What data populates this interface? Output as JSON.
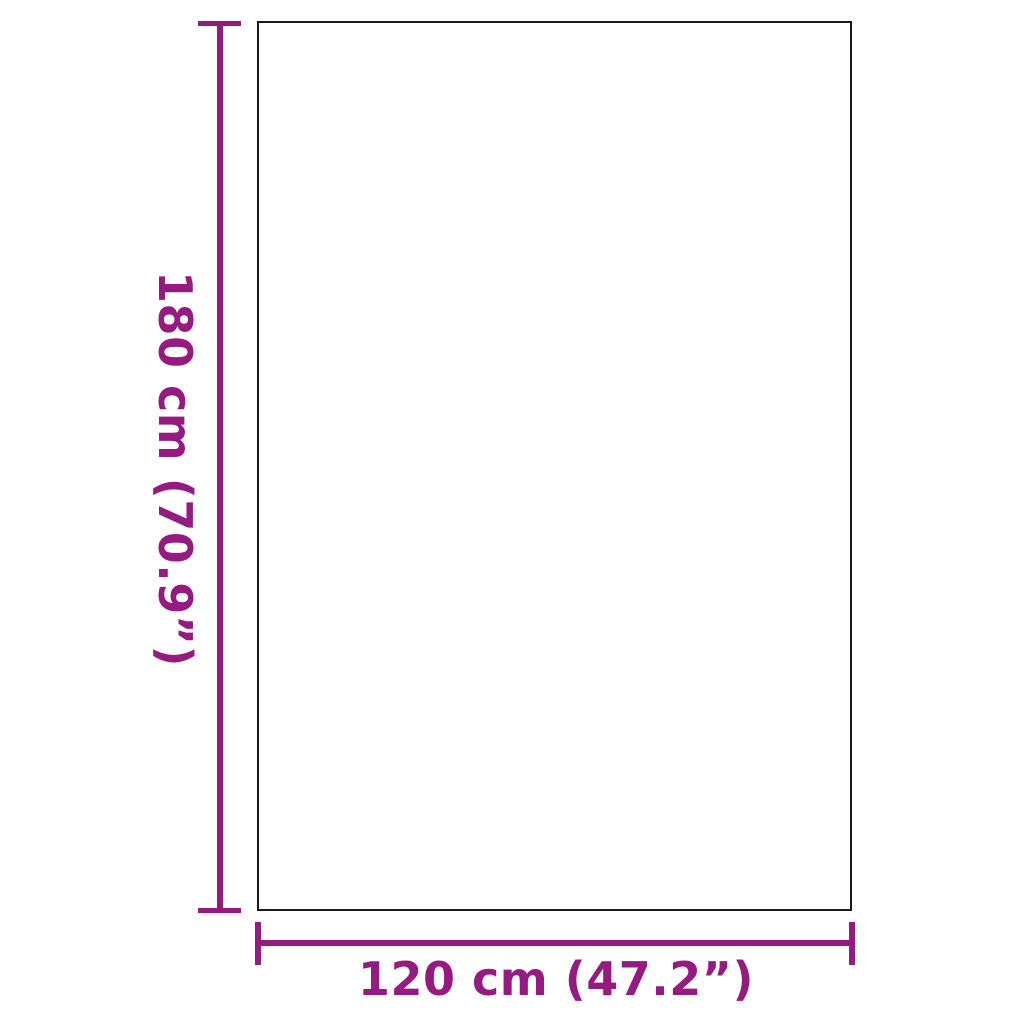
{
  "diagram": {
    "type": "product-dimension-diagram",
    "vertical_dimension": {
      "label": "180 cm (70.9”)",
      "metric": "180 cm",
      "imperial": "70.9”"
    },
    "horizontal_dimension": {
      "label": "120 cm (47.2”)",
      "metric": "120 cm",
      "imperial": "47.2”"
    },
    "colors": {
      "accent": "#951b81",
      "outline": "#1b1b1b",
      "background": "#ffffff"
    }
  }
}
